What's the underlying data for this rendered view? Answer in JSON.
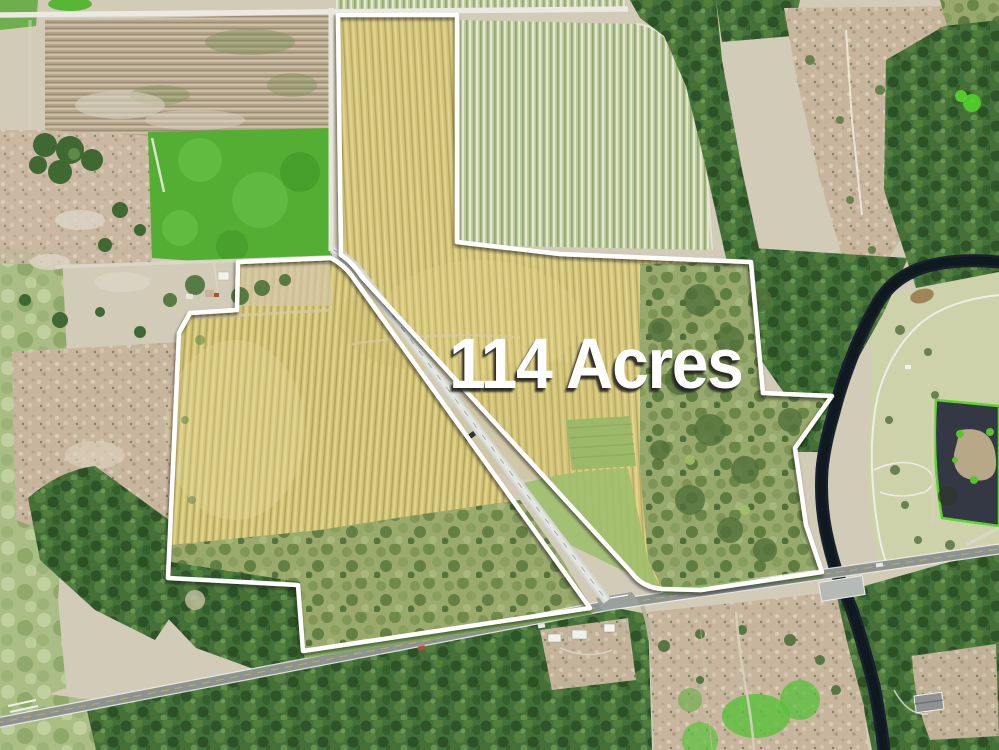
{
  "overlay": {
    "acreage_label": "114 Acres",
    "label_color": "#ffffff",
    "label_shadow_color": "rgba(30,30,30,0.8)",
    "boundary_color": "#ffffff"
  },
  "scene": {
    "type": "aerial-drone-photo-of-land-parcel",
    "features": [
      "orchard fields",
      "tilled field",
      "green pasture",
      "forest",
      "river",
      "retention pond",
      "highway",
      "rural road",
      "bridge",
      "farm buildings",
      "parcel boundary outline"
    ]
  }
}
